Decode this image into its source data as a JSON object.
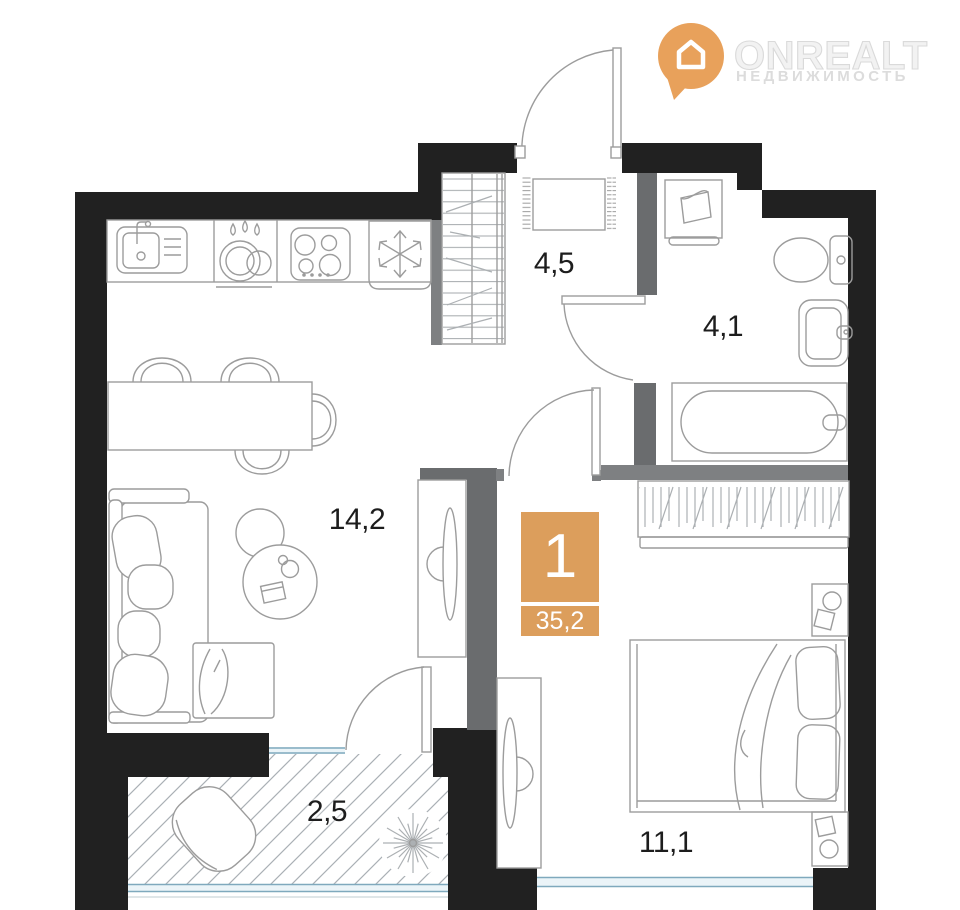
{
  "logo": {
    "brand": "ONREALT",
    "tagline": "НЕДВИЖИМОСТЬ",
    "icon": "location-pin-house-icon"
  },
  "unit_badge": {
    "rooms_count": "1",
    "total_area": "35,2"
  },
  "rooms": [
    {
      "id": "hallway",
      "area_label": "4,5"
    },
    {
      "id": "bathroom",
      "area_label": "4,1"
    },
    {
      "id": "living-kitchen",
      "area_label": "14,2"
    },
    {
      "id": "balcony",
      "area_label": "2,5"
    },
    {
      "id": "bedroom",
      "area_label": "11,1"
    }
  ],
  "colors": {
    "wall": "#212121",
    "partition": "#6a6c6e",
    "partition_light": "#7e8082",
    "line": "#9c9c9c",
    "line_light": "#acb0b3",
    "hatch": "#aab0b5",
    "window_frame": "#7fa9bd",
    "window_fill": "#ebf4f8",
    "label": "#1d1d1d",
    "badge_orange": "#dc9e5c",
    "logo_orange": "#e8a15b",
    "logo_text": "#f2f2f2",
    "logo_sub": "#dcdcdc",
    "bg": "#ffffff"
  }
}
